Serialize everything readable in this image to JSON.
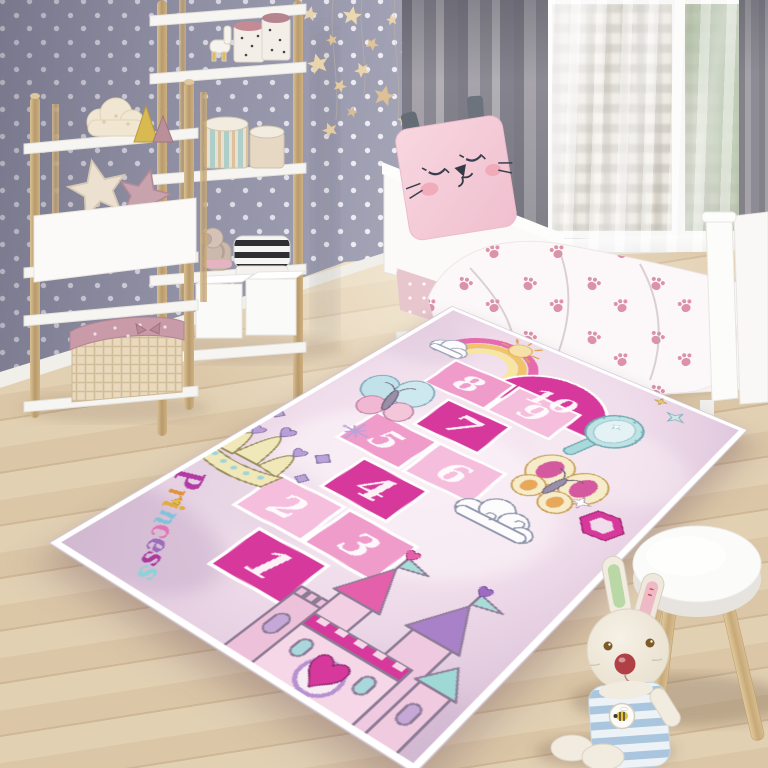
{
  "scene": {
    "description": "Kids bedroom with princess hopscotch play rug",
    "palette": {
      "wall": "#9d9db1",
      "wall_dots": "#f6f4fa",
      "floor_wood": "#e0cdae",
      "curtain_gray": "#8c8a92",
      "furniture_white": "#f7f6f3",
      "shelf_wood": "#c8ab7c",
      "bedding_paw_pink": "#d987a0",
      "cat_pillow_pink": "#f6cfda",
      "bunny_shirt_blue": "#a9c6de"
    },
    "items": [
      "polka-dot-wallpaper",
      "ladder-shelves",
      "daybed",
      "cat-pillow",
      "paw-print-duvet",
      "gray-curtains",
      "window",
      "star-garland",
      "wooden-stool",
      "bunny-plush",
      "woven-basket",
      "storage-cubes",
      "star-pillows",
      "toy-canisters"
    ]
  },
  "rug": {
    "word": "Princess",
    "letters": [
      {
        "ch": "P",
        "color": "#b23aa4"
      },
      {
        "ch": "r",
        "color": "#e2913a"
      },
      {
        "ch": "i",
        "color": "#e0ac3e"
      },
      {
        "ch": "n",
        "color": "#82c3da"
      },
      {
        "ch": "c",
        "color": "#e272b4"
      },
      {
        "ch": "e",
        "color": "#9a6cba"
      },
      {
        "ch": "s",
        "color": "#aa3a9e"
      },
      {
        "ch": "s",
        "color": "#8ed2d6"
      }
    ],
    "hopscotch_numbers": [
      "1",
      "2",
      "3",
      "4",
      "5",
      "6",
      "7",
      "8",
      "9",
      "10"
    ],
    "palette": {
      "base": "#f3e3ef",
      "shade": "#c9aecb",
      "border": "#ffffff",
      "square_dark": "#d6399b",
      "square_mid": "#ef9ccb",
      "square_light": "#f6bedd",
      "arch": "#d6399b",
      "numbers": "#ffffff"
    },
    "motifs": [
      "rainbow-sun",
      "clouds",
      "butterfly-teal",
      "butterfly-yellow",
      "crown",
      "hand-mirror",
      "gem-ring",
      "castle",
      "stars",
      "sparkle-doodle"
    ]
  }
}
